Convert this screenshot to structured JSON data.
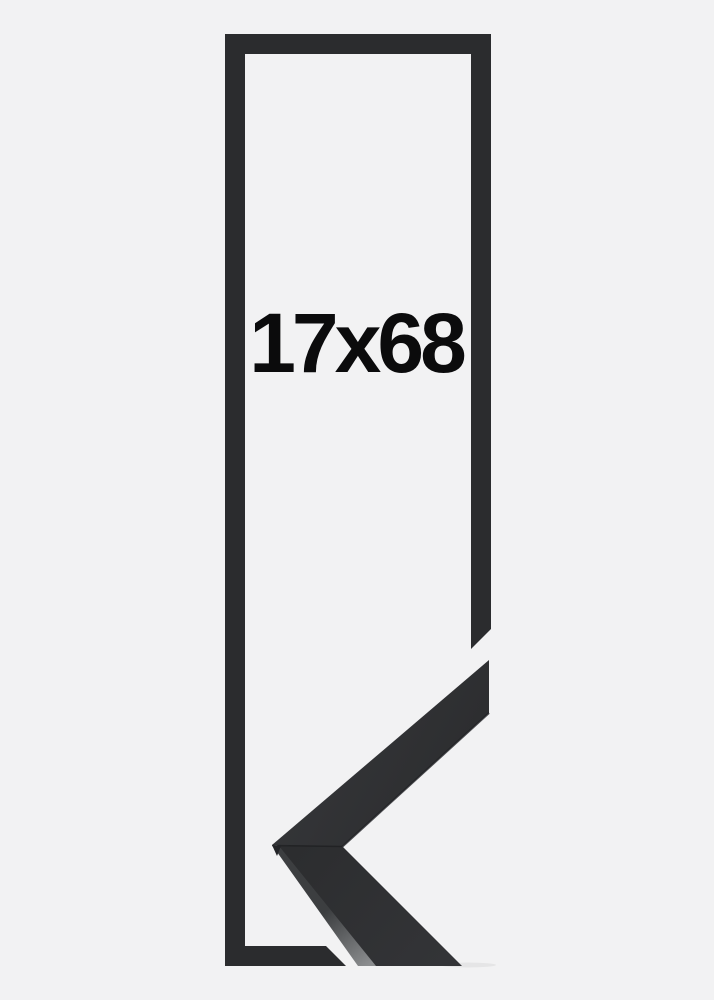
{
  "page": {
    "background_color": "#f2f2f3"
  },
  "product_image": {
    "size_label": "17x68",
    "outline_color": "#2b2c2e",
    "sample": {
      "face_top_light": "#37383b",
      "face_top_dark": "#2a2b2d",
      "face_bottom_near": "#2c2d2f",
      "face_bottom_far": "#333437",
      "chamfer_top": "#3c3e40",
      "chamfer_bottom": "#8b8d8f",
      "seam_color": "#1d1e20",
      "edge_color": "#202124",
      "tip_color": "#232427",
      "shadow_color": "#000000"
    }
  }
}
